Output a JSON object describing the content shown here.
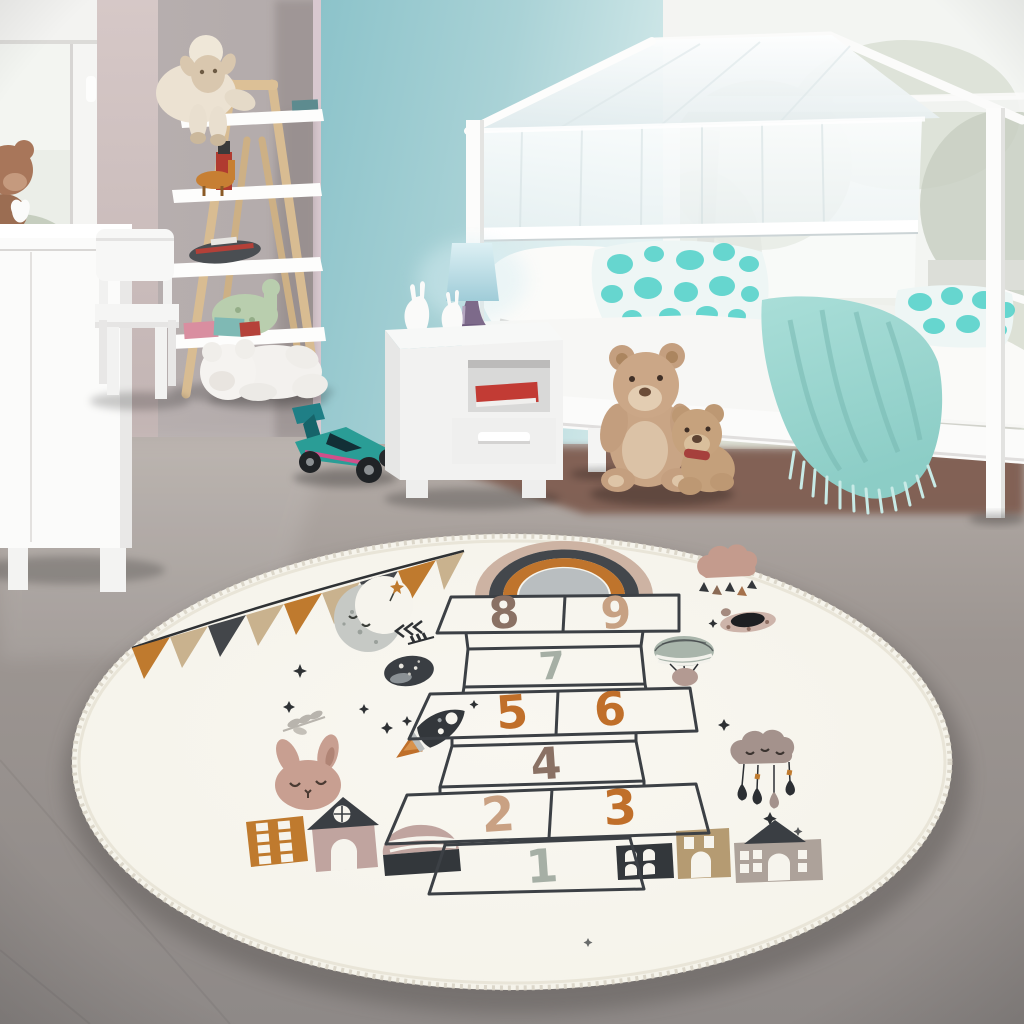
{
  "meta": {
    "description": "Children's bedroom photo with a round hopscotch play rug",
    "photo_type": "product-photo"
  },
  "rug": {
    "shape": "round",
    "base_color": "#f6f4ed",
    "line_color": "#3c4045",
    "numbers": [
      {
        "value": "8",
        "color": "#8a7164"
      },
      {
        "value": "9",
        "color": "#c7a183"
      },
      {
        "value": "7",
        "color": "#a6afa5"
      },
      {
        "value": "5",
        "color": "#c06f2a"
      },
      {
        "value": "6",
        "color": "#c06f2a"
      },
      {
        "value": "4",
        "color": "#8a7164"
      },
      {
        "value": "2",
        "color": "#c9a183"
      },
      {
        "value": "3",
        "color": "#c06f2a"
      },
      {
        "value": "1",
        "color": "#a6afa5"
      }
    ],
    "flag_colors": [
      "#bf7a2e",
      "#c9b28e",
      "#43464a",
      "#c9b28e",
      "#bf7a2e",
      "#c9b28e",
      "#43464a",
      "#bf7a2e",
      "#c9b28e"
    ],
    "motifs": [
      "bunting-flags",
      "crescent-moon",
      "rainbow",
      "rain-cloud",
      "ufo",
      "hot-air-balloon",
      "planet",
      "rocket",
      "bunny-face",
      "sleeping-cloud-mobile",
      "houses",
      "stars",
      "leaf-sprigs"
    ]
  },
  "room": {
    "accent_wall_color": "#9fcdd3",
    "blanket_color": "#9ed9d3",
    "furniture": [
      "house-canopy-bed",
      "nightstand",
      "ladder-shelf",
      "kids-chair",
      "dresser"
    ],
    "toys": [
      "plush-lamb",
      "white-teddy-bear",
      "brown-teddy-bear-large",
      "brown-teddy-bear-small",
      "rc-buggy-car",
      "green-dino",
      "red-toy-figure",
      "toy-plane",
      "bunny-figurines",
      "dresser-teddy"
    ],
    "textiles": [
      "white-pillow",
      "teal-watercolor-pillows",
      "teal-fringed-blanket",
      "sheer-canopy",
      "roller-blind"
    ]
  }
}
